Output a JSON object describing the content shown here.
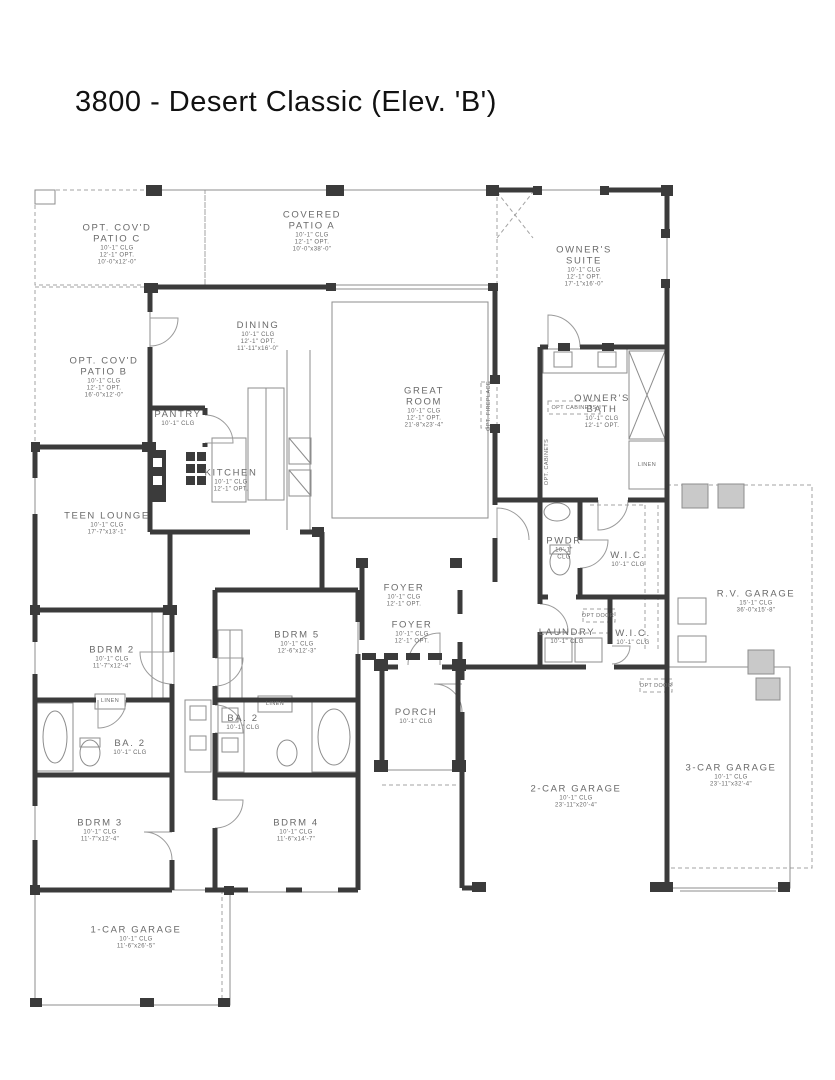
{
  "title": "3800 - Desert Classic (Elev. 'B')",
  "colors": {
    "wall": "#3b3b3b",
    "thin_line": "#8d8d8d",
    "dashed_line": "#a3a3a3",
    "label_text": "#6a6a6a",
    "title_text": "#111111",
    "background": "#ffffff"
  },
  "rooms": [
    {
      "id": "opt-covd-patio-c",
      "name_lines": [
        "OPT. COV'D",
        "PATIO C"
      ],
      "sub_lines": [
        "10'-1\" CLG",
        "12'-1\" OPT.",
        "10'-0\"x12'-0\""
      ],
      "x": 117,
      "y": 245
    },
    {
      "id": "covered-patio-a",
      "name_lines": [
        "COVERED",
        "PATIO A"
      ],
      "sub_lines": [
        "10'-1\" CLG",
        "12'-1\" OPT.",
        "10'-0\"x38'-0\""
      ],
      "x": 312,
      "y": 232
    },
    {
      "id": "owners-suite",
      "name_lines": [
        "OWNER'S",
        "SUITE"
      ],
      "sub_lines": [
        "10'-1\" CLG",
        "12'-1\" OPT.",
        "17'-1\"x16'-0\""
      ],
      "x": 584,
      "y": 267
    },
    {
      "id": "opt-covd-patio-b",
      "name_lines": [
        "OPT. COV'D",
        "PATIO B"
      ],
      "sub_lines": [
        "10'-1\" CLG",
        "12'-1\" OPT.",
        "16'-0\"x12'-0\""
      ],
      "x": 104,
      "y": 378
    },
    {
      "id": "dining",
      "name_lines": [
        "DINING"
      ],
      "sub_lines": [
        "10'-1\" CLG",
        "12'-1\" OPT.",
        "11'-11\"x16'-0\""
      ],
      "x": 258,
      "y": 337
    },
    {
      "id": "great-room",
      "name_lines": [
        "GREAT",
        "ROOM"
      ],
      "sub_lines": [
        "10'-1\" CLG",
        "12'-1\" OPT.",
        "21'-8\"x23'-4\""
      ],
      "x": 424,
      "y": 408
    },
    {
      "id": "pantry",
      "name_lines": [
        "PANTRY"
      ],
      "sub_lines": [
        "10'-1\" CLG"
      ],
      "x": 178,
      "y": 419
    },
    {
      "id": "kitchen",
      "name_lines": [
        "KITCHEN"
      ],
      "sub_lines": [
        "10'-1\" CLG",
        "12'-1\" OPT."
      ],
      "x": 231,
      "y": 481
    },
    {
      "id": "owners-bath",
      "name_lines": [
        "OWNER'S",
        "BATH"
      ],
      "sub_lines": [
        "10'-1\" CLG",
        "12'-1\" OPT."
      ],
      "x": 602,
      "y": 412
    },
    {
      "id": "teen-lounge",
      "name_lines": [
        "TEEN LOUNGE"
      ],
      "sub_lines": [
        "10'-1\" CLG",
        "17'-7\"x13'-1\""
      ],
      "x": 107,
      "y": 524
    },
    {
      "id": "foyer-1",
      "name_lines": [
        "FOYER"
      ],
      "sub_lines": [
        "10'-1\" CLG",
        "12'-1\" OPT."
      ],
      "x": 404,
      "y": 596
    },
    {
      "id": "foyer-2",
      "name_lines": [
        "FOYER"
      ],
      "sub_lines": [
        "10'-1\" CLG",
        "12'-1\" OPT."
      ],
      "x": 412,
      "y": 633
    },
    {
      "id": "pwdr",
      "name_lines": [
        "PWDR"
      ],
      "sub_lines": [
        "10'-1\"",
        "CLG"
      ],
      "x": 564,
      "y": 549
    },
    {
      "id": "wic-1",
      "name_lines": [
        "W.I.C."
      ],
      "sub_lines": [
        "10'-1\" CLG"
      ],
      "x": 628,
      "y": 560
    },
    {
      "id": "laundry",
      "name_lines": [
        "LAUNDRY"
      ],
      "sub_lines": [
        "10'-1\" CLG"
      ],
      "x": 567,
      "y": 637
    },
    {
      "id": "wic-2",
      "name_lines": [
        "W.I.C."
      ],
      "sub_lines": [
        "10'-1\" CLG"
      ],
      "x": 633,
      "y": 638
    },
    {
      "id": "rv-garage",
      "name_lines": [
        "R.V. GARAGE"
      ],
      "sub_lines": [
        "15'-1\" CLG",
        "36'-0\"x15'-8\""
      ],
      "x": 756,
      "y": 602
    },
    {
      "id": "bdrm-2",
      "name_lines": [
        "BDRM 2"
      ],
      "sub_lines": [
        "10'-1\" CLG",
        "11'-7\"x12'-4\""
      ],
      "x": 112,
      "y": 658
    },
    {
      "id": "bdrm-5",
      "name_lines": [
        "BDRM 5"
      ],
      "sub_lines": [
        "10'-1\" CLG",
        "12'-6\"x12'-3\""
      ],
      "x": 297,
      "y": 643
    },
    {
      "id": "ba-2-left",
      "name_lines": [
        "BA. 2"
      ],
      "sub_lines": [
        "10'-1\" CLG"
      ],
      "x": 130,
      "y": 748
    },
    {
      "id": "ba-2-right",
      "name_lines": [
        "BA. 2"
      ],
      "sub_lines": [
        "10'-1\" CLG"
      ],
      "x": 243,
      "y": 723
    },
    {
      "id": "porch",
      "name_lines": [
        "PORCH"
      ],
      "sub_lines": [
        "10'-1\" CLG"
      ],
      "x": 416,
      "y": 717
    },
    {
      "id": "bdrm-3",
      "name_lines": [
        "BDRM 3"
      ],
      "sub_lines": [
        "10'-1\" CLG",
        "11'-7\"x12'-4\""
      ],
      "x": 100,
      "y": 831
    },
    {
      "id": "bdrm-4",
      "name_lines": [
        "BDRM 4"
      ],
      "sub_lines": [
        "10'-1\" CLG",
        "11'-6\"x14'-7\""
      ],
      "x": 296,
      "y": 831
    },
    {
      "id": "garage-2-car",
      "name_lines": [
        "2-CAR GARAGE"
      ],
      "sub_lines": [
        "10'-1\" CLG",
        "23'-11\"x20'-4\""
      ],
      "x": 576,
      "y": 797
    },
    {
      "id": "garage-3-car",
      "name_lines": [
        "3-CAR GARAGE"
      ],
      "sub_lines": [
        "10'-1\" CLG",
        "23'-11\"x32'-4\""
      ],
      "x": 731,
      "y": 776
    },
    {
      "id": "garage-1-car",
      "name_lines": [
        "1-CAR GARAGE"
      ],
      "sub_lines": [
        "10'-1\" CLG",
        "11'-6\"x26'-5\""
      ],
      "x": 136,
      "y": 938
    }
  ],
  "small_labels": [
    {
      "id": "opt-fireplace",
      "text": "OPT. FIREPLACE",
      "x": 489,
      "y": 406,
      "rotate": -90
    },
    {
      "id": "opt-cabinets-vertical",
      "text": "OPT. CABINETS",
      "x": 547,
      "y": 462,
      "rotate": -90
    },
    {
      "id": "opt-cabinets-box",
      "text": "OPT CABINETS",
      "x": 574,
      "y": 408,
      "rotate": 0
    },
    {
      "id": "linen-owners-bath",
      "text": "LINEN",
      "x": 647,
      "y": 465,
      "rotate": 0
    },
    {
      "id": "opt-door-laundry",
      "text": "OPT DOOR",
      "x": 598,
      "y": 616,
      "rotate": 0
    },
    {
      "id": "opt-door-garage",
      "text": "OPT DOOR",
      "x": 656,
      "y": 686,
      "rotate": 0
    },
    {
      "id": "linen-ba-left",
      "text": "LINEN",
      "x": 110,
      "y": 701,
      "rotate": 0
    },
    {
      "id": "linen-ba-right",
      "text": "LINEN",
      "x": 275,
      "y": 704,
      "rotate": 0
    }
  ]
}
